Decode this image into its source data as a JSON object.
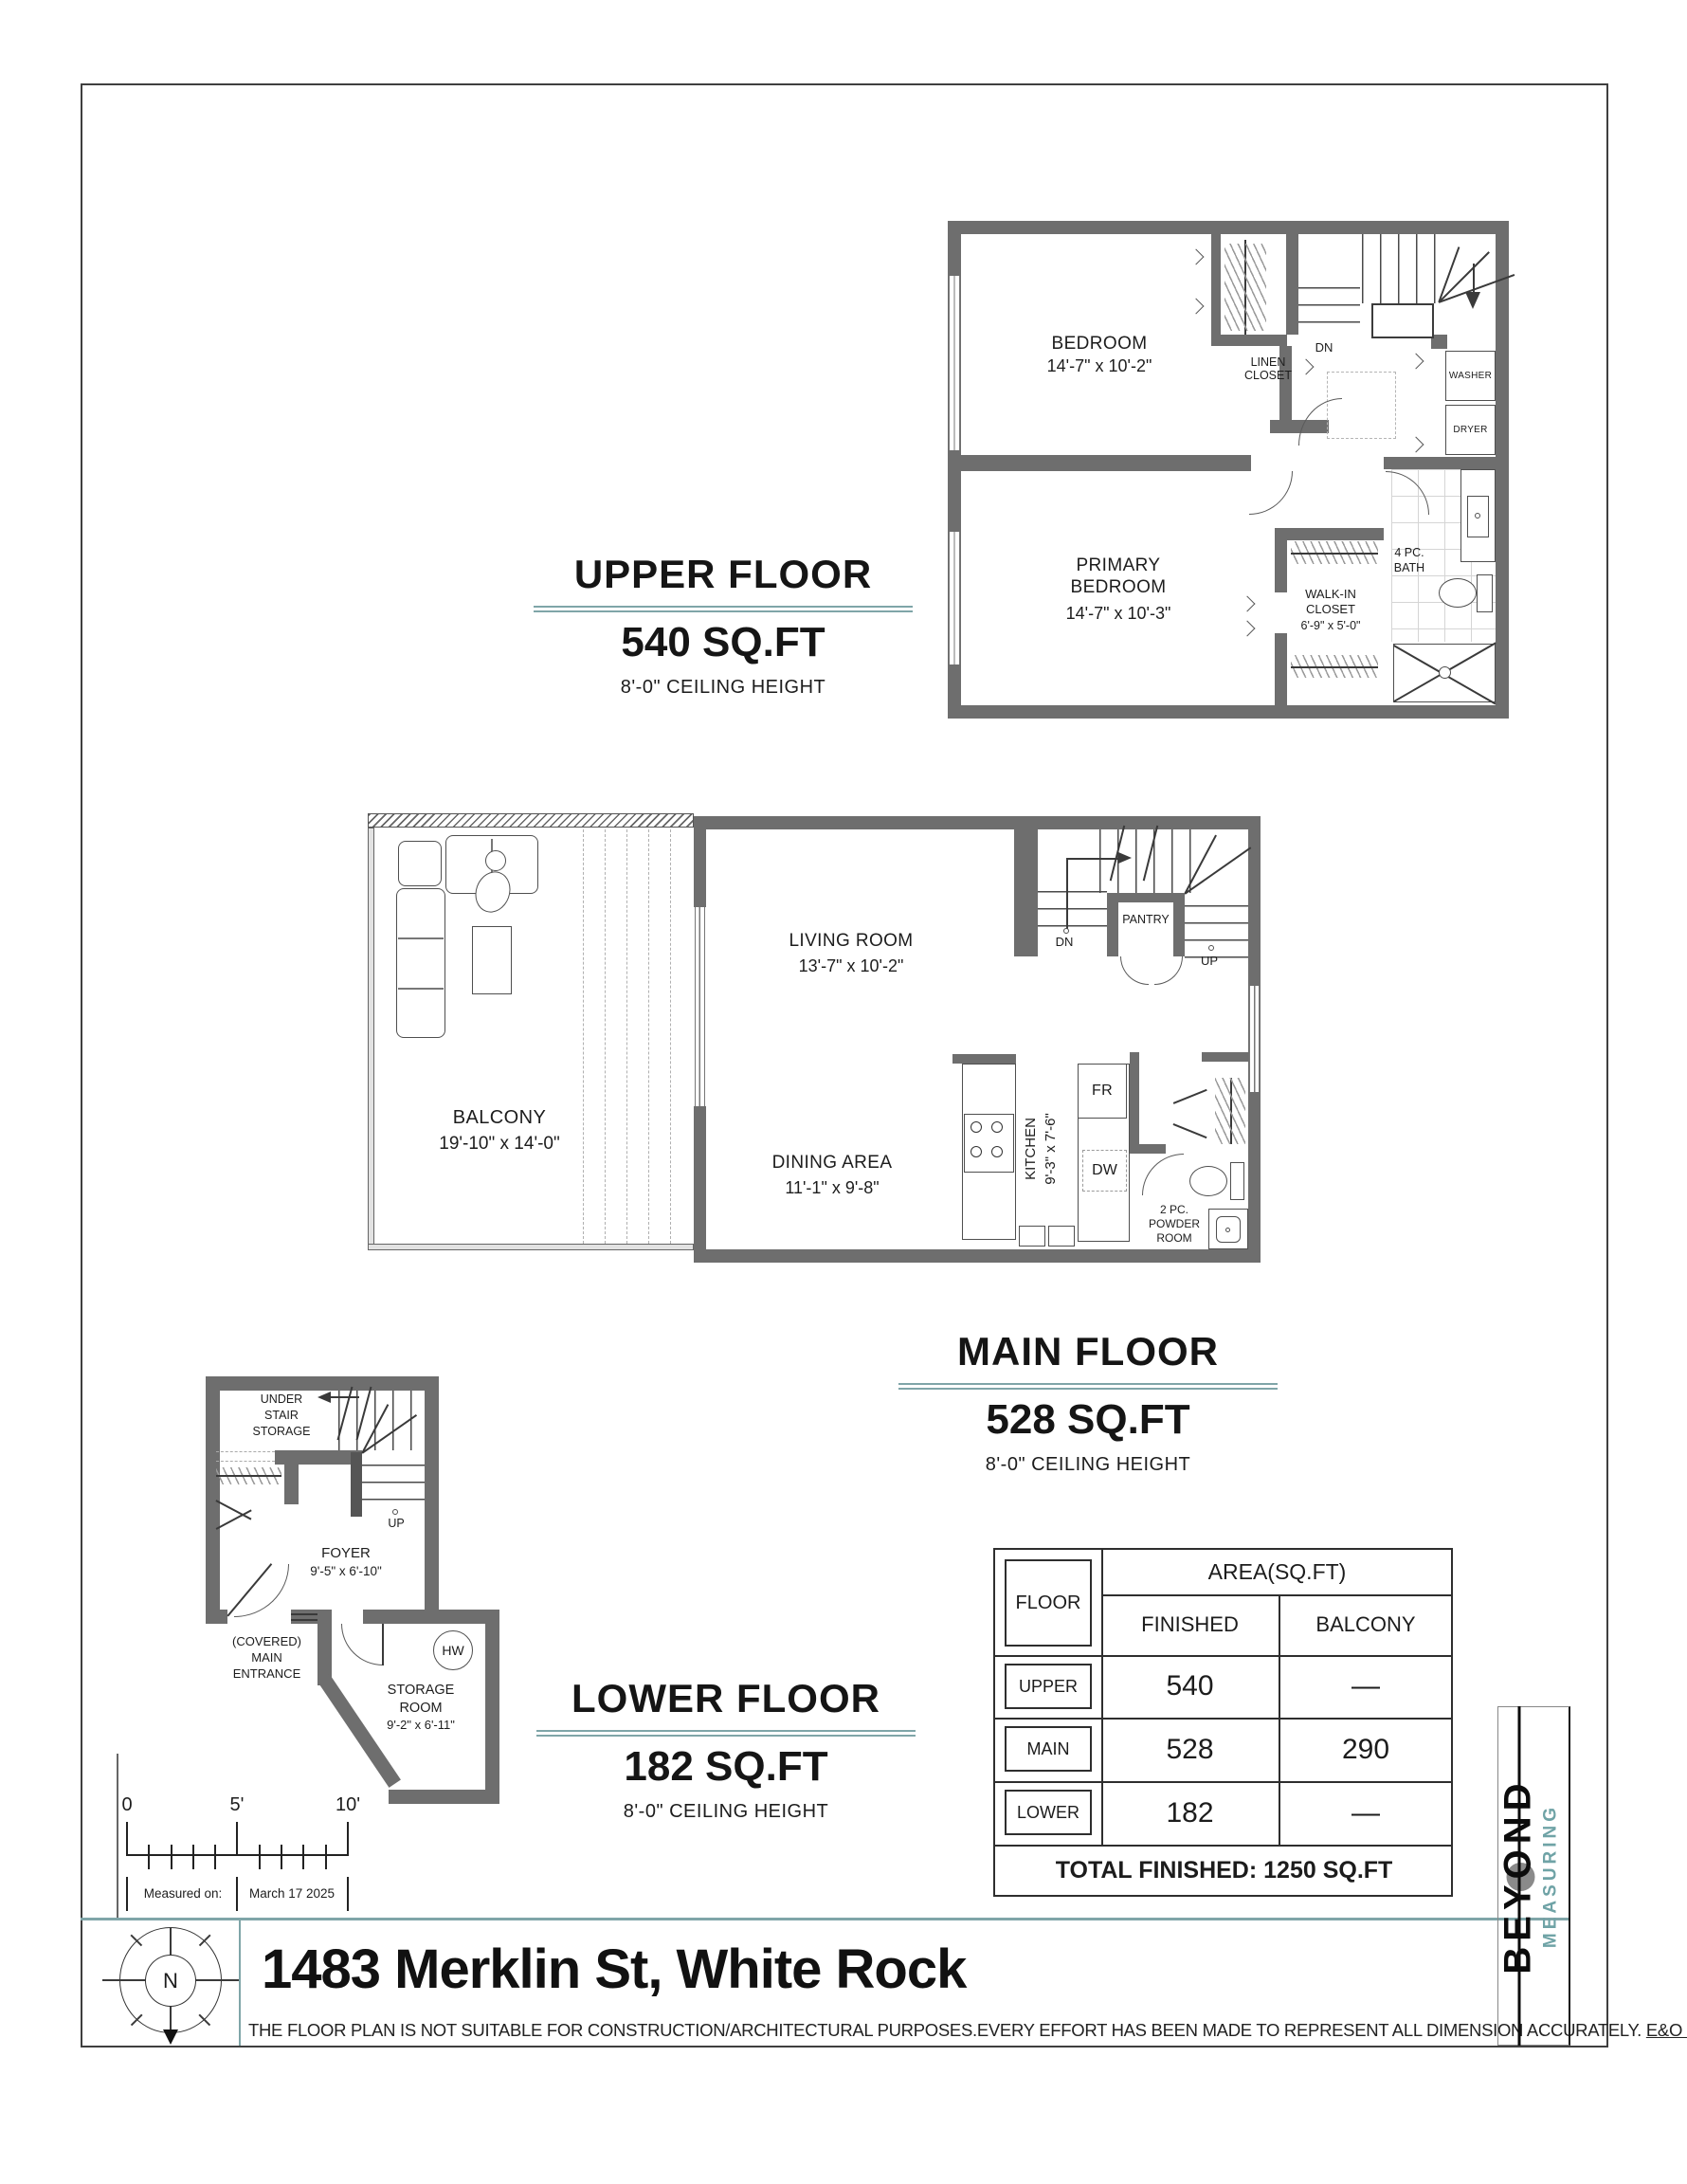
{
  "colors": {
    "accent": "#7fa5a8",
    "wall": "#6e6e6e"
  },
  "sections": {
    "upper": {
      "title": "UPPER FLOOR",
      "area": "540 SQ.FT",
      "ceiling": "8'-0\" CEILING HEIGHT"
    },
    "main": {
      "title": "MAIN FLOOR",
      "area": "528 SQ.FT",
      "ceiling": "8'-0\" CEILING HEIGHT"
    },
    "lower": {
      "title": "LOWER FLOOR",
      "area": "182 SQ.FT",
      "ceiling": "8'-0\" CEILING HEIGHT"
    }
  },
  "upper_plan": {
    "bedroom": "BEDROOM",
    "bedroom_dims": "14'-7\" x 10'-2\"",
    "linen_closet": "LINEN CLOSET",
    "dn": "DN",
    "washer": "WASHER",
    "dryer": "DRYER",
    "primary": "PRIMARY BEDROOM",
    "primary_dims": "14'-7\" x 10'-3\"",
    "walk_in": "WALK-IN CLOSET",
    "walk_in_dims": "6'-9\" x 5'-0\"",
    "bath": "4 PC. BATH"
  },
  "main_plan": {
    "balcony": "BALCONY",
    "balcony_dims": "19'-10\" x 14'-0\"",
    "living": "LIVING ROOM",
    "living_dims": "13'-7\" x 10'-2\"",
    "dining": "DINING AREA",
    "dining_dims": "11'-1\" x 9'-8\"",
    "kitchen": "KITCHEN",
    "kitchen_dims": "9'-3\" x 7'-6\"",
    "pantry": "PANTRY",
    "dn": "DN",
    "up": "UP",
    "fridge": "FR",
    "dishwasher": "DW",
    "powder": "2 PC. POWDER ROOM"
  },
  "lower_plan": {
    "under_stair": "UNDER STAIR STORAGE",
    "up": "UP",
    "foyer": "FOYER",
    "foyer_dims": "9'-5\" x 6'-10\"",
    "entrance": "(COVERED) MAIN ENTRANCE",
    "storage": "STORAGE ROOM",
    "storage_dims": "9'-2\" x 6'-11\"",
    "hot_water": "HW"
  },
  "area_table": {
    "floor_header": "FLOOR",
    "area_header": "AREA(SQ.FT)",
    "finished_header": "FINISHED",
    "balcony_header": "BALCONY",
    "rows": [
      {
        "floor": "UPPER",
        "finished": "540",
        "balcony": "—"
      },
      {
        "floor": "MAIN",
        "finished": "528",
        "balcony": "290"
      },
      {
        "floor": "LOWER",
        "finished": "182",
        "balcony": "—"
      }
    ],
    "total": "TOTAL FINISHED: 1250 SQ.FT"
  },
  "scale_bar": {
    "zero": "0",
    "five": "5'",
    "ten": "10'",
    "measured_label": "Measured on:",
    "measured_date": "March 17  2025"
  },
  "footer": {
    "compass_n": "N",
    "address": "1483 Merklin St, White Rock",
    "disclaimer": "THE  FLOOR PLAN  IS NOT SUITABLE FOR CONSTRUCTION/ARCHITECTURAL PURPOSES.EVERY EFFORT HAS BEEN MADE TO REPRESENT ALL DIMENSION ACCURATELY. ",
    "disclaimer_link": "E&O INSURED",
    "disclaimer_end": ".",
    "logo_primary": "BEYOND",
    "logo_secondary": "MEASURING"
  }
}
